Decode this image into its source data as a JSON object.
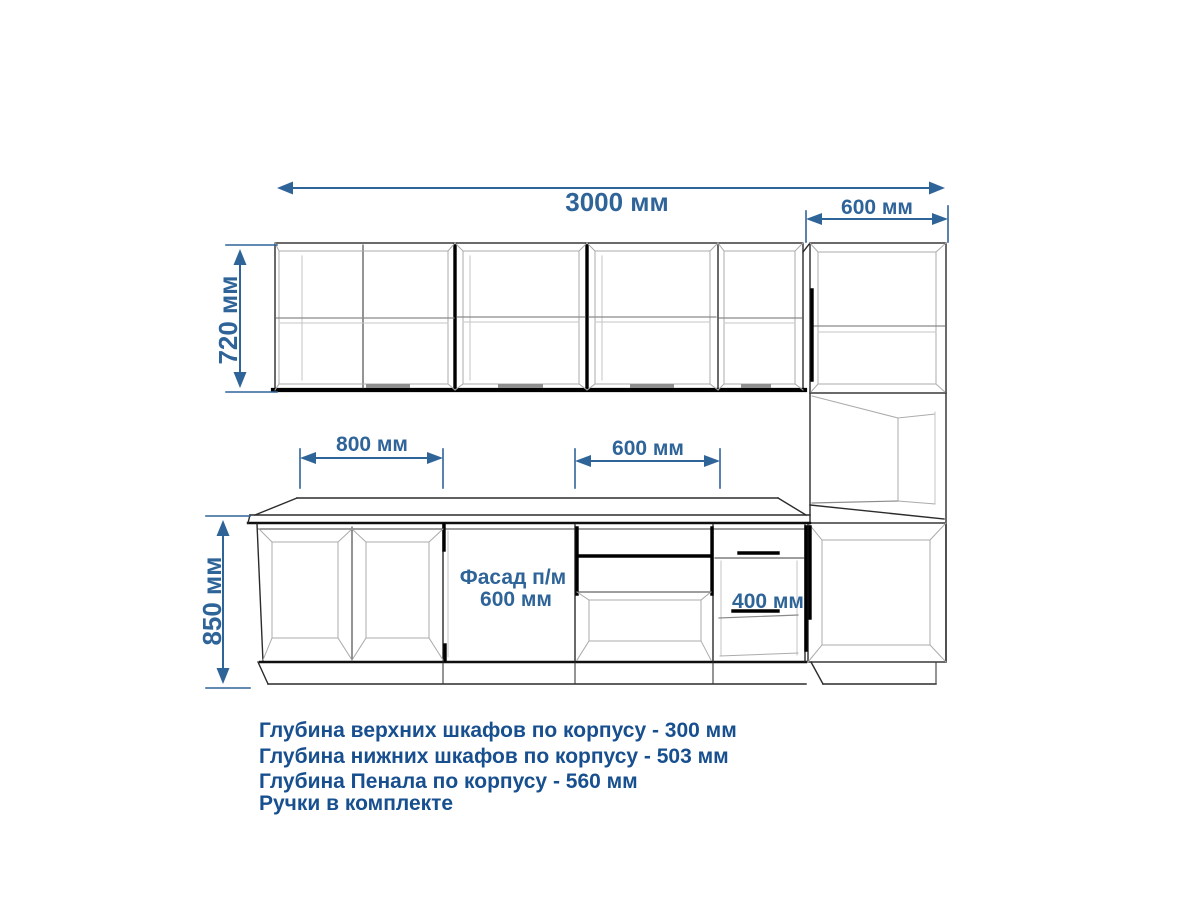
{
  "colors": {
    "dimension_accent": "#2f6499",
    "notes_text": "#174f8f",
    "drawing_line": "#2b2b2b",
    "drawing_light_line": "#ababab",
    "background": "#ffffff"
  },
  "dimensions": {
    "total_width": "3000 мм",
    "pencil_cabinet_width": "600 мм",
    "upper_cabinet_height": "720 мм",
    "left_base_section_width": "800 мм",
    "middle_base_section_width": "600 мм",
    "base_cabinet_height": "850 мм",
    "facade_label_line1": "Фасад п/м",
    "facade_label_line2": "600 мм",
    "narrow_base_section_width": "400 мм"
  },
  "notes": {
    "line1": "Глубина верхних шкафов по корпусу - 300 мм",
    "line2": "Глубина нижних шкафов по корпусу - 503 мм",
    "line3": "Глубина Пенала по корпусу - 560 мм",
    "line4": "Ручки в комплекте"
  }
}
